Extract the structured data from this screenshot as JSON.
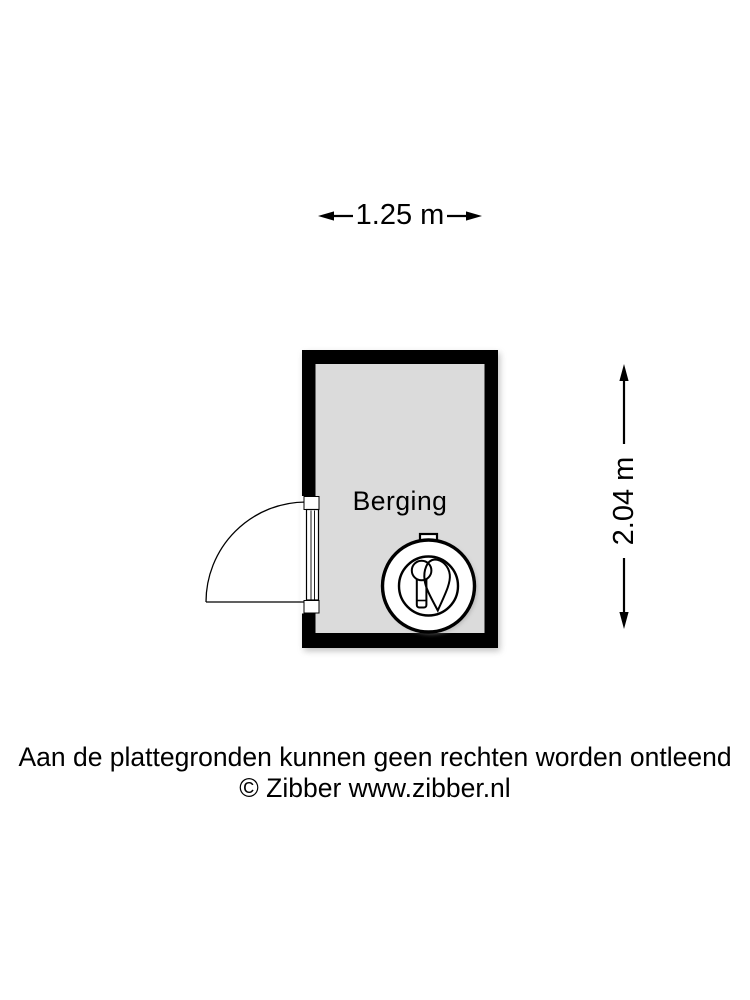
{
  "page": {
    "background": "#ffffff"
  },
  "floorplan": {
    "room": {
      "label": "Berging",
      "floor_color": "#dbdbdb",
      "wall_color": "#000000"
    },
    "dimensions": {
      "width_label": "1.25 m",
      "height_label": "2.04 m"
    },
    "fixture_icon": "boiler-icon",
    "door": "single swing door, left wall, opening outward"
  },
  "footer": {
    "disclaimer": "Aan de plattegronden kunnen geen rechten worden ontleend",
    "copyright": "© Zibber www.zibber.nl"
  }
}
